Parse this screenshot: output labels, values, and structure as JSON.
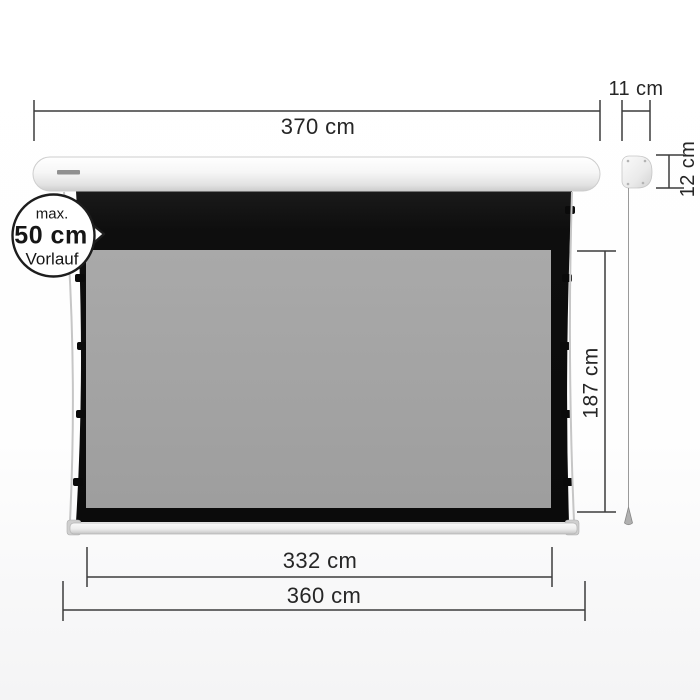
{
  "labels": {
    "total_width": "370 cm",
    "housing_side_width": "11 cm",
    "housing_side_height": "12 cm",
    "viewing_height": "187 cm",
    "viewing_width": "332 cm",
    "bottom_bar_width": "360 cm"
  },
  "callout": {
    "line1": "max.",
    "line2": "50 cm",
    "line3": "Vorlauf"
  },
  "colors": {
    "dimension_ink": "#3c3c3c",
    "label_ink": "#262626",
    "cloth_black": "#0e0e0e",
    "viewing_gray": "#a4a4a4",
    "housing_white": "#f4f4f4",
    "cord_gray": "#c6c6c6"
  }
}
